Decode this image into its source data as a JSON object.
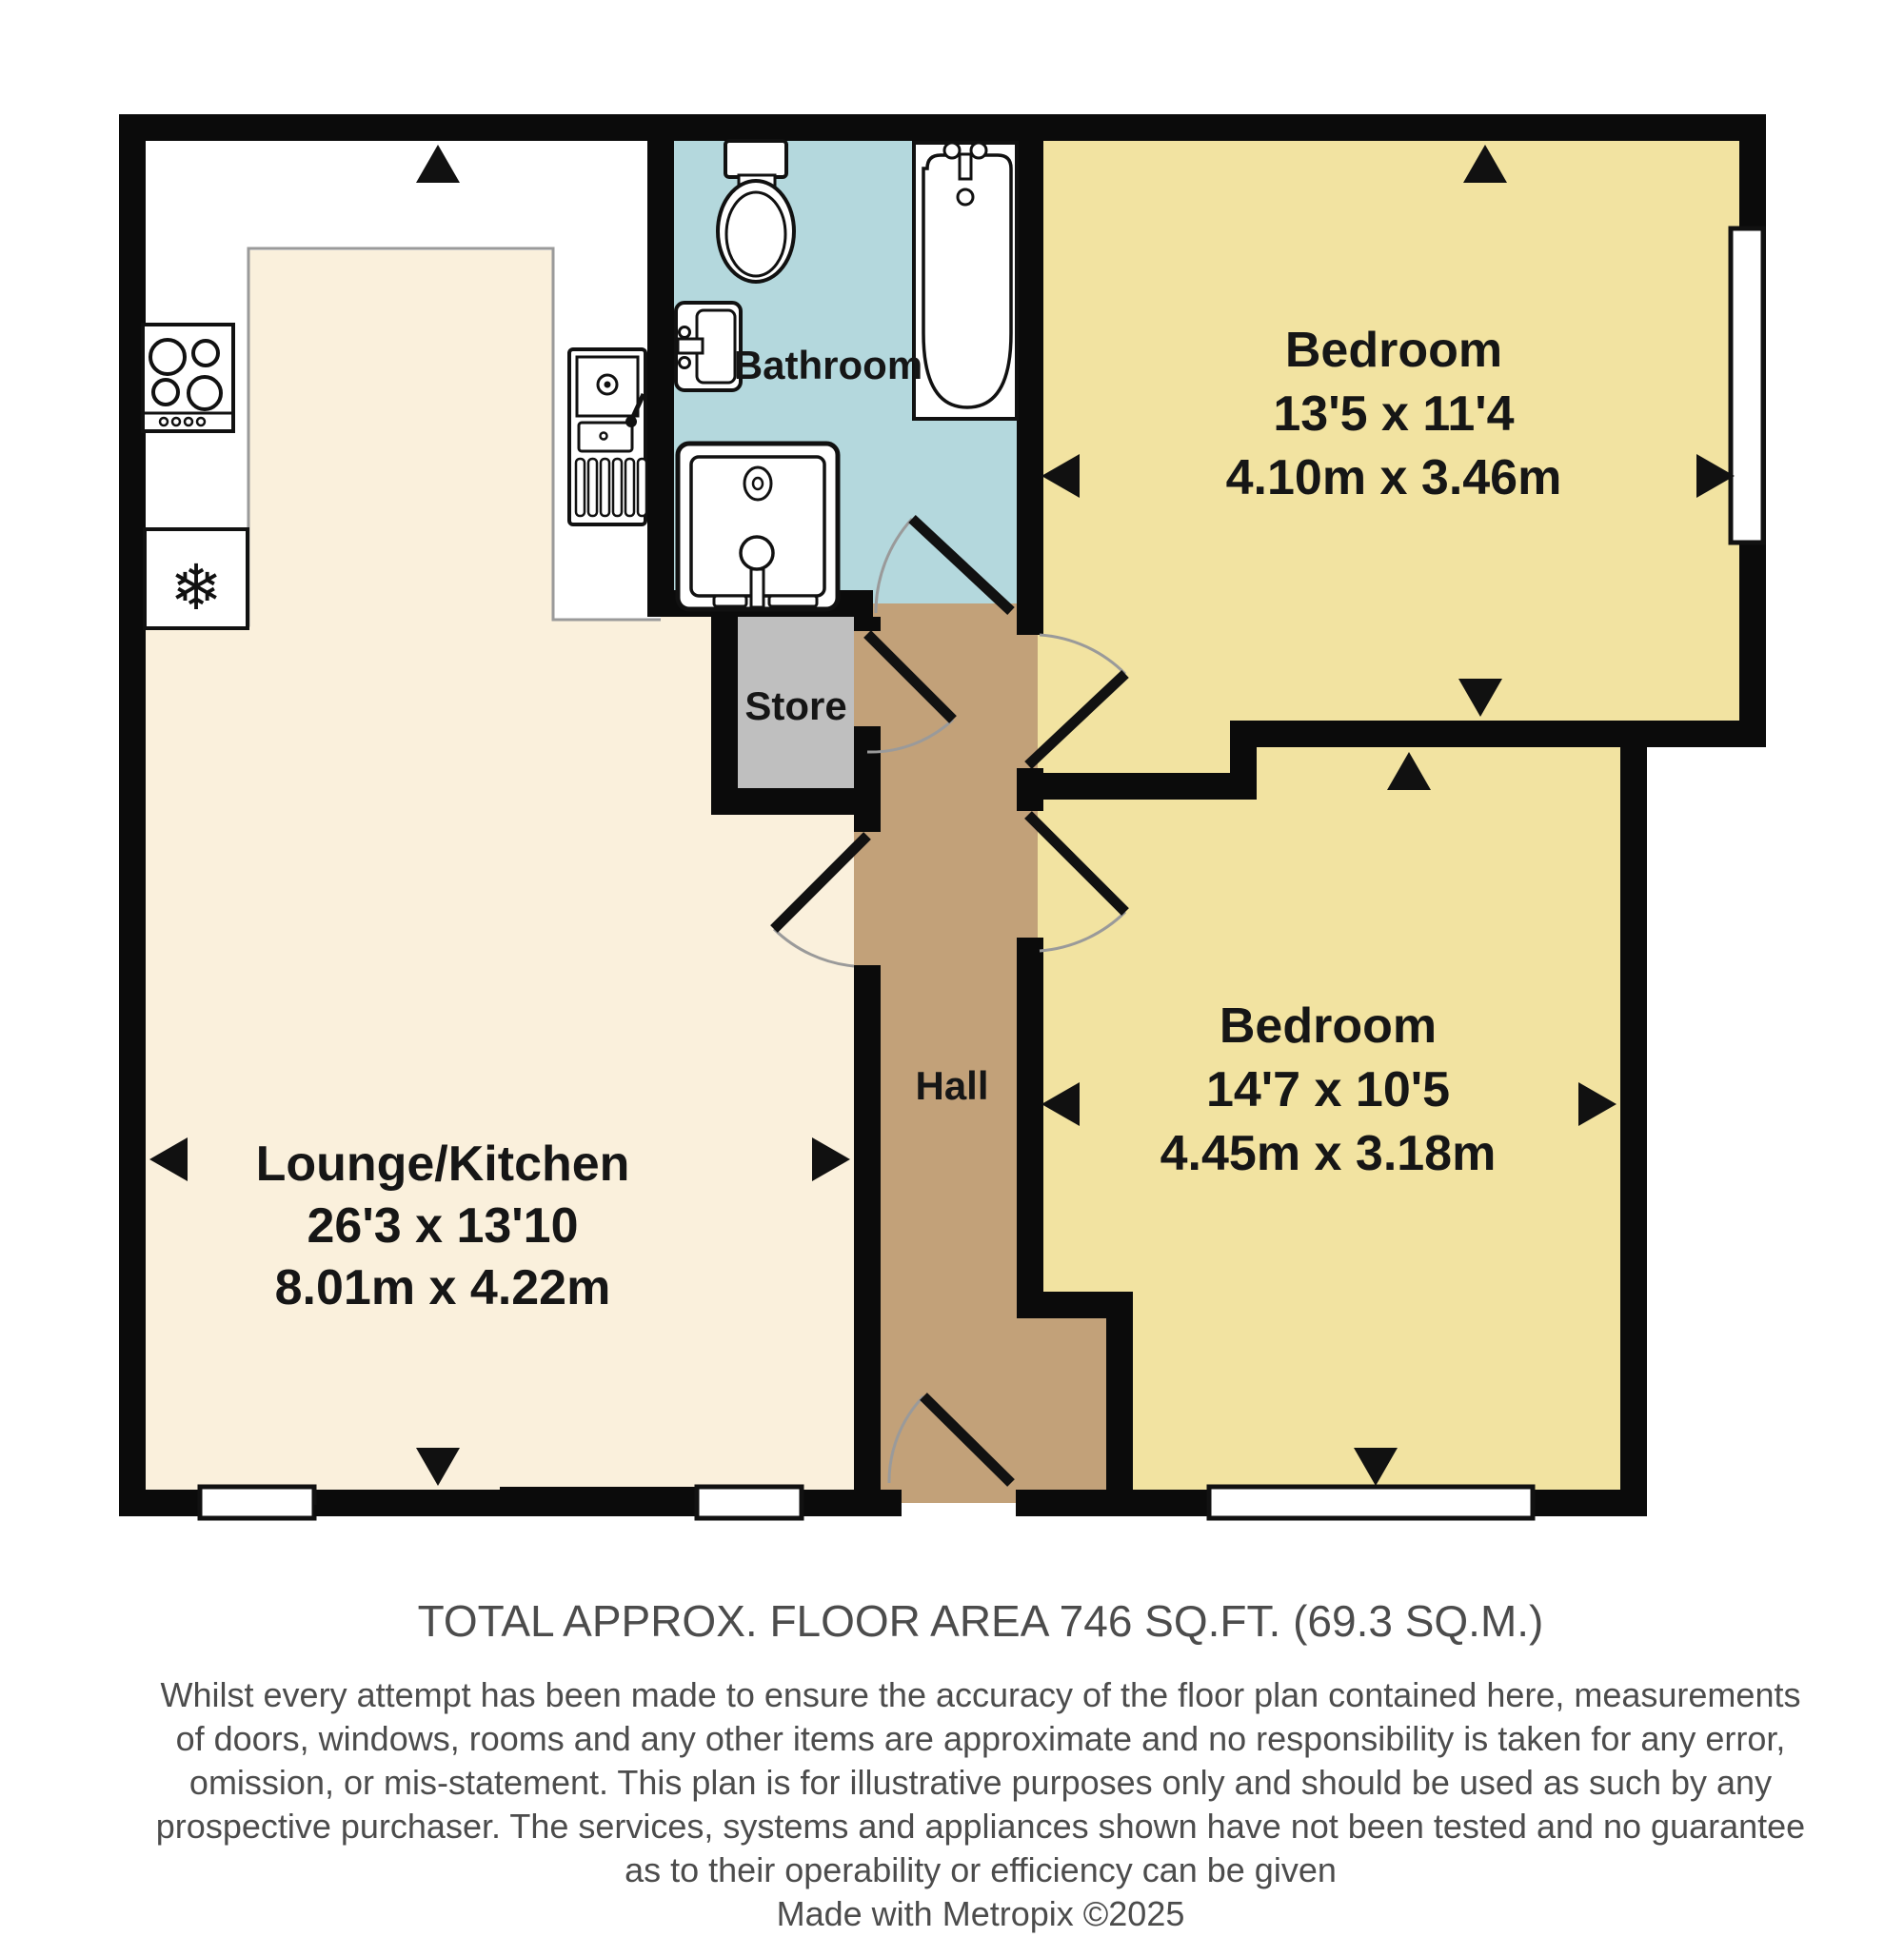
{
  "plan": {
    "rooms": {
      "lounge": {
        "name": "Lounge/Kitchen",
        "imperial": "26'3 x 13'10",
        "metric": "8.01m x 4.22m"
      },
      "bathroom": {
        "name": "Bathroom"
      },
      "store": {
        "name": "Store"
      },
      "hall": {
        "name": "Hall"
      },
      "bedroom1": {
        "name": "Bedroom",
        "imperial": "13'5 x 11'4",
        "metric": "4.10m x 3.46m"
      },
      "bedroom2": {
        "name": "Bedroom",
        "imperial": "14'7 x 10'5",
        "metric": "4.45m x 3.18m"
      }
    },
    "icons": {
      "freezer": "❄"
    },
    "colors": {
      "lounge": "#FAF0DC",
      "bedroom": "#F2E3A1",
      "bathroom": "#B4D8DD",
      "hall": "#C2A179",
      "store": "#BFBFBF",
      "kitchen_zone": "#FFFFFF",
      "wall": "#0B0B0B"
    }
  },
  "footer": {
    "total_area": "TOTAL APPROX. FLOOR AREA 746 SQ.FT. (69.3 SQ.M.)",
    "disclaimer_lines": [
      "Whilst every attempt has been made to ensure the accuracy of the floor plan contained here, measurements",
      "of doors, windows, rooms and any other items are approximate and no responsibility is taken for any error,",
      "omission, or mis-statement. This plan is for illustrative purposes only and should be used as such by any",
      "prospective purchaser. The services, systems and appliances shown have not been tested and no guarantee",
      "as to their operability or efficiency can be given"
    ],
    "credit": "Made with Metropix ©2025"
  }
}
